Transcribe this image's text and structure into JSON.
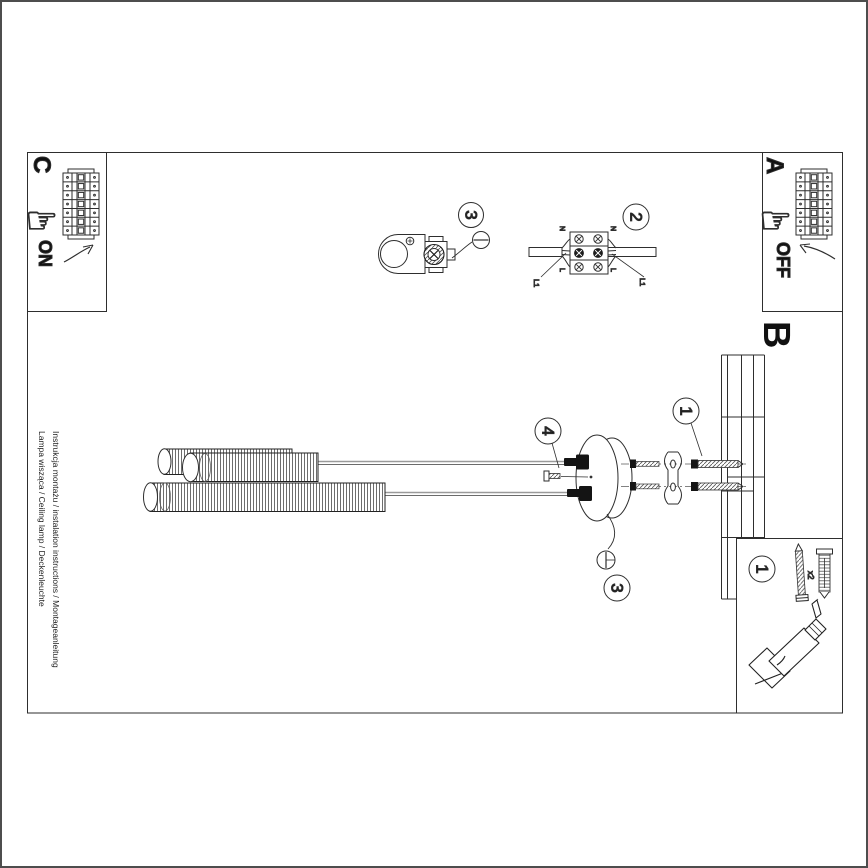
{
  "sheet": {
    "footer": {
      "line1": "Instrukcja montażu / instalation instructions / Montageanleitung",
      "line2": "Lampa wisząca / Ceiling lamp / Deckenleuchte"
    }
  },
  "panels": {
    "a": {
      "label": "A",
      "state": "OFF"
    },
    "c": {
      "label": "C",
      "state": "ON"
    },
    "b_label": "B"
  },
  "steps": {
    "s1": "1",
    "s2": "2",
    "s3": "3",
    "s4": "4"
  },
  "parts": {
    "badge": "1",
    "qty": "x2"
  },
  "terminal": {
    "n": "N",
    "l": "L",
    "l1": "L1"
  }
}
